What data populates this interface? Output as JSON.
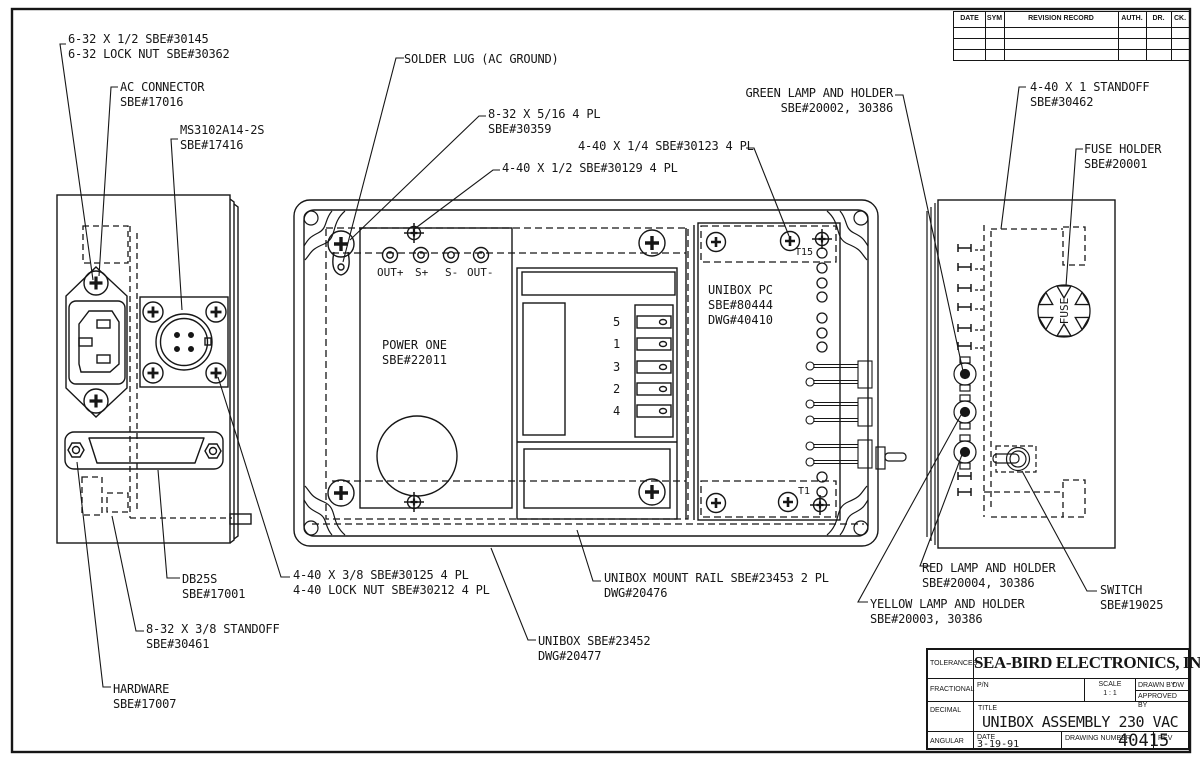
{
  "colors": {
    "ink": "#161616",
    "paper": "#ffffff"
  },
  "revision_table": {
    "headers": [
      "DATE",
      "SYM",
      "REVISION RECORD",
      "AUTH.",
      "DR.",
      "CK."
    ],
    "empty_rows": 3
  },
  "title_block": {
    "tolerances": "TOLERANCES",
    "fractional": "FRACTIONAL",
    "decimal": "DECIMAL",
    "angular": "ANGULAR",
    "company": "SEA-BIRD ELECTRONICS, INC",
    "pn": "P/N",
    "scale_label": "SCALE",
    "scale_value": "1 : 1",
    "drawn_by_label": "DRAWN BY",
    "drawn_by_value": "DW",
    "approved_by_label": "APPROVED BY",
    "title_label": "TITLE",
    "title_value": "UNIBOX ASSEMBLY 230 VAC",
    "date_label": "DATE",
    "date_value": "3-19-91",
    "drawing_number_label": "DRAWING NUMBER",
    "drawing_number_value": "40415",
    "rev_label": "REV"
  },
  "callouts": {
    "fastener_6_32": "6-32 X 1/2 SBE#30145\n6-32 LOCK NUT SBE#30362",
    "ac_connector": "AC CONNECTOR\nSBE#17016",
    "ms_connector": "MS3102A14-2S\nSBE#17416",
    "solder_lug": "SOLDER LUG (AC GROUND)",
    "screw_8_32_5_16": "8-32 X 5/16 4 PL\nSBE#30359",
    "screw_4_40_1_4": "4-40 X 1/4 SBE#30123 4 PL",
    "screw_4_40_1_2": "4-40 X 1/2 SBE#30129 4 PL",
    "green_lamp": "GREEN LAMP AND HOLDER\nSBE#20002, 30386",
    "standoff_4_40": "4-40 X 1 STANDOFF\nSBE#30462",
    "fuse_holder": "FUSE HOLDER\nSBE#20001",
    "db25s": "DB25S\nSBE#17001",
    "screw_4_40_3_8": "4-40 X 3/8 SBE#30125 4 PL\n4-40 LOCK NUT SBE#30212 4 PL",
    "standoff_8_32": "8-32 X 3/8 STANDOFF\nSBE#30461",
    "hardware": "HARDWARE\nSBE#17007",
    "mount_rail": "UNIBOX MOUNT RAIL SBE#23453 2 PL\nDWG#20476",
    "unibox": "UNIBOX SBE#23452\nDWG#20477",
    "red_lamp": "RED LAMP AND HOLDER\nSBE#20004, 30386",
    "yellow_lamp": "YELLOW LAMP AND HOLDER\nSBE#20003, 30386",
    "switch": "SWITCH\nSBE#19025"
  },
  "components": {
    "power_one": "POWER ONE\nSBE#22011",
    "unibox_pc": "UNIBOX PC\nSBE#80444\nDWG#40410",
    "terminals": [
      "OUT+",
      "S+",
      "S-",
      "OUT-"
    ],
    "tab_numbers": [
      "5",
      "1",
      "3",
      "2",
      "4"
    ],
    "t15": "T15",
    "t1": "T1",
    "fuse": "FUSE"
  }
}
